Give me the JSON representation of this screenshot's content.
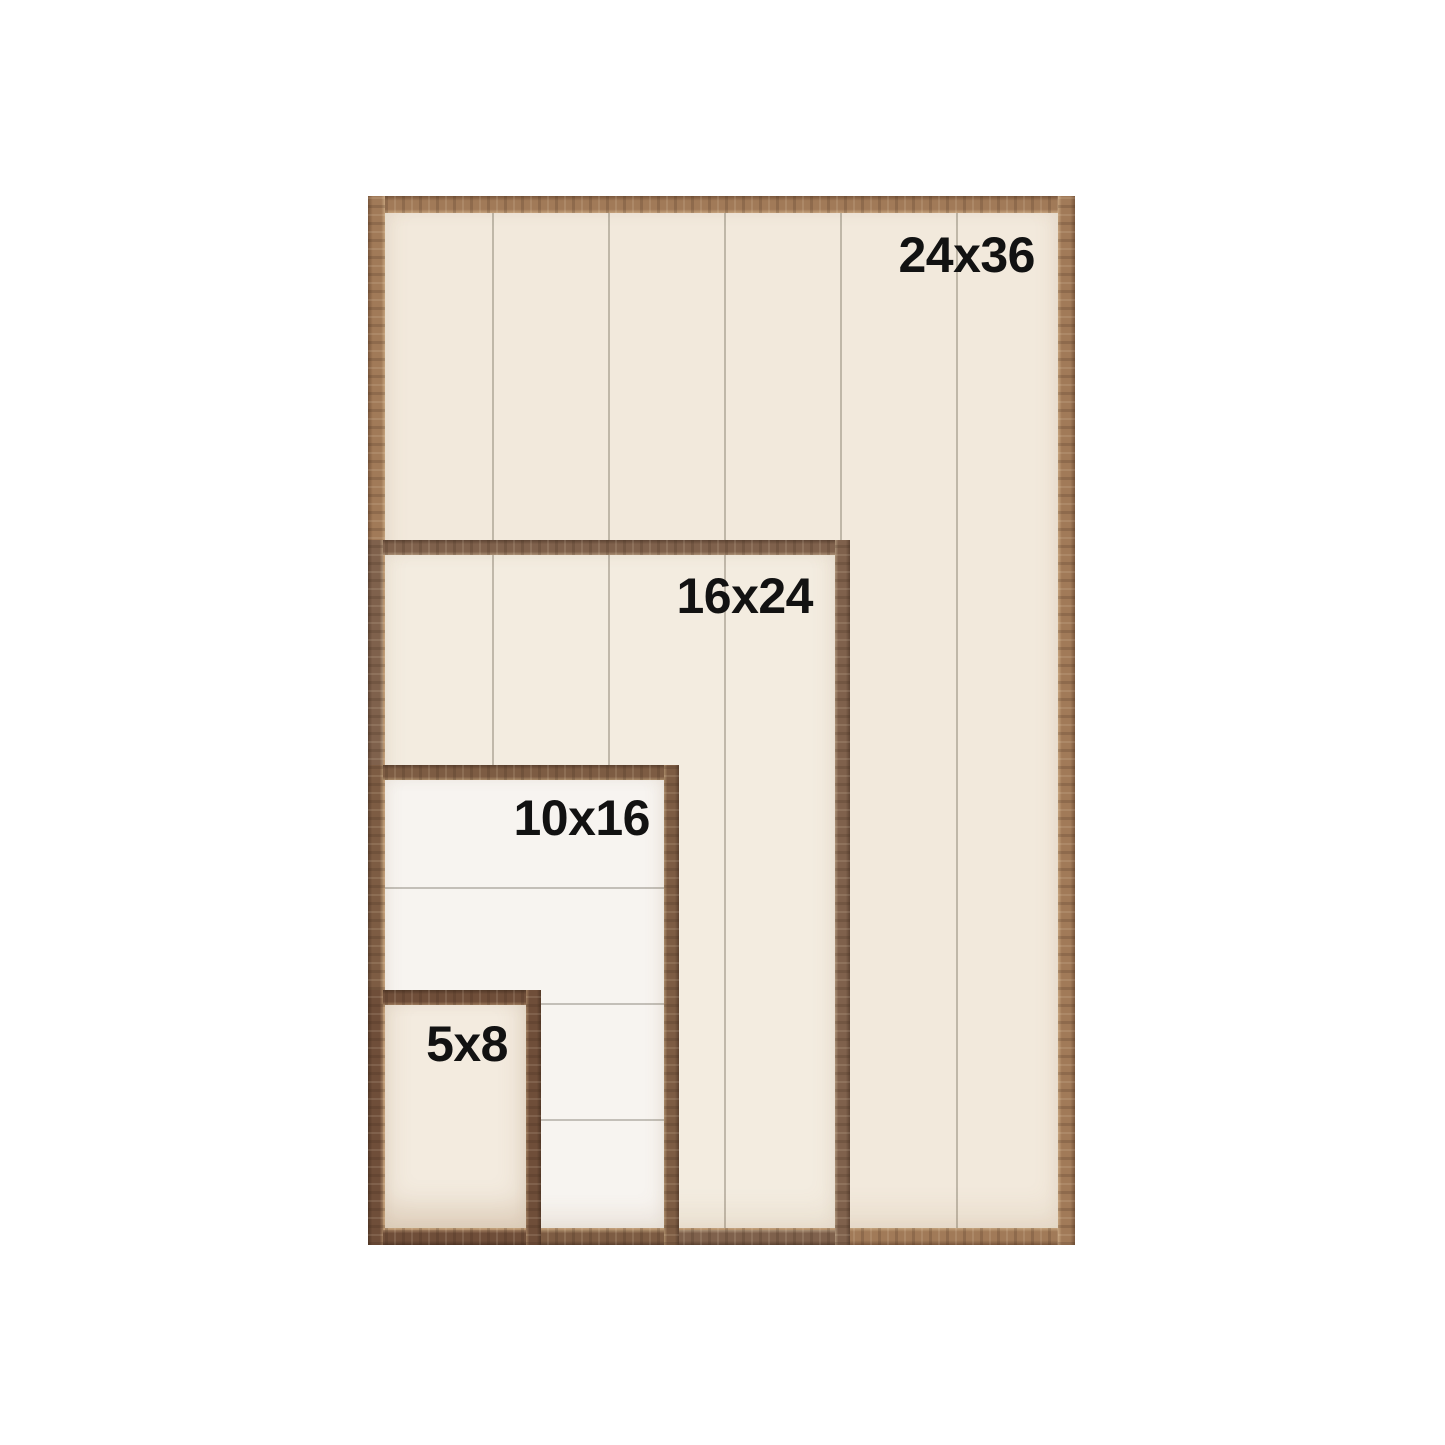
{
  "image_type": "frame-size-comparison",
  "background_color": "#ffffff",
  "label_text_color": "#121212",
  "frames": [
    {
      "label": "24x36",
      "width_in": 24,
      "height_in": 36,
      "wood_color": "#a17a58",
      "panel_color": "#f2e9dc",
      "plank_direction": "vertical"
    },
    {
      "label": "16x24",
      "width_in": 16,
      "height_in": 24,
      "wood_color": "#7f614c",
      "panel_color": "#f3ece0",
      "plank_direction": "vertical"
    },
    {
      "label": "10x16",
      "width_in": 10,
      "height_in": 16,
      "wood_color": "#7d5c43",
      "panel_color": "#f7f4f0",
      "plank_direction": "horizontal"
    },
    {
      "label": "5x8",
      "width_in": 5,
      "height_in": 8,
      "wood_color": "#6f4e39",
      "panel_color": "#f3ebdf",
      "plank_direction": "none"
    }
  ]
}
